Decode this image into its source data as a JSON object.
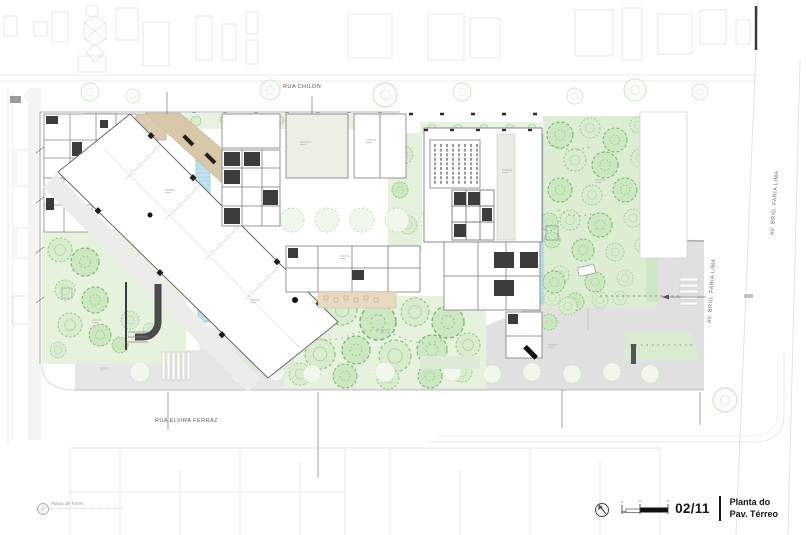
{
  "streets": {
    "rua_chilon": "RUA CHILON",
    "rua_elvira_ferraz": "RUA ELVIRA FERRAZ",
    "av_faria_lima_1": "AV. BRIG. FARIA LIMA",
    "av_faria_lima_2": "AV. BRIG. FARIA LIMA"
  },
  "title_block": {
    "page_number": "02/11",
    "title_line1": "Planta do",
    "title_line2": "Pav. Térreo"
  },
  "logo": {
    "text": "Planta de Torres"
  },
  "icons": {
    "north_arrow_icon": "compass-circle-with-needle",
    "scale_bar_icon": "graphic-scale-segmented-bar"
  },
  "colors": {
    "garden_green": "#e6f2de",
    "garden_green_deep": "#dcedd4",
    "tree_green": "#8cc487",
    "pool_blue": "#c3e2ef",
    "ramp_tan": "#d8c7a8",
    "paving_gray": "#e6e6e6",
    "wall_dark": "#3c3c3c",
    "context_gray": "#e2e2e2"
  }
}
